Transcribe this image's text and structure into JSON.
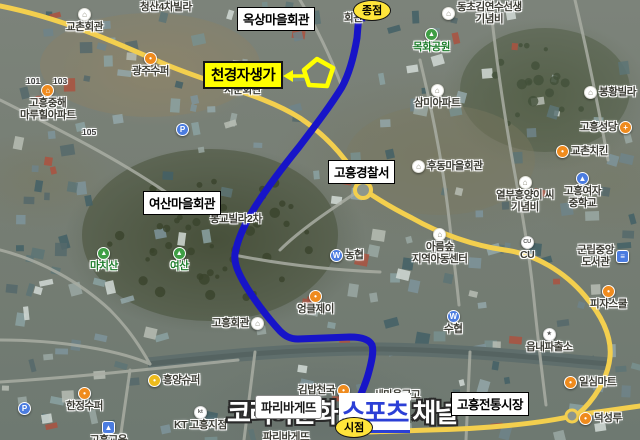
{
  "map_type": "satellite-route-map",
  "badges": {
    "end": "종점",
    "start": "시점"
  },
  "callout": {
    "label": "천경자생가"
  },
  "boxed_labels": {
    "oksang": "옥상마을회관",
    "police": "고흥경찰서",
    "yeosan": "여산마을회관",
    "market": "고흥전통시장",
    "paris": "파리바게뜨"
  },
  "watermark": {
    "part1": "코리아문화",
    "part2": "스포츠",
    "part3": "채널"
  },
  "icons": {
    "mountain": "▲",
    "hall": "⌂",
    "dot": "•",
    "bank": "W",
    "parking": "P",
    "church": "+",
    "school": "▲",
    "police": "★",
    "cu": "CU",
    "kt": "kt",
    "library": "≡",
    "home": "⌂"
  },
  "colors": {
    "route": "#1714c8",
    "road_main": "#f3cf4e",
    "highlight": "#ffff00",
    "badge": "#ffe53a",
    "watermark_accent": "#2b3fd6"
  },
  "pois": [
    {
      "label": "청산4차빌라"
    },
    {
      "label": "교촌회관"
    },
    {
      "label": "광주수퍼"
    },
    {
      "label": "고흥중해\n마루힐아파트"
    },
    {
      "label": "101"
    },
    {
      "label": "103"
    },
    {
      "label": "105"
    },
    {
      "label": "서문회관"
    },
    {
      "label": "동초김연수선생\n기념비"
    },
    {
      "label": "목화공원"
    },
    {
      "label": "삼미아파트"
    },
    {
      "label": "봉황빌라"
    },
    {
      "label": "고흥성당"
    },
    {
      "label": "교촌치킨"
    },
    {
      "label": "고흥여자\n중학교"
    },
    {
      "label": "열부흥양이 씨\n기념비"
    },
    {
      "label": "후동마을회관"
    },
    {
      "label": "봉교빌라2차"
    },
    {
      "label": "마치산"
    },
    {
      "label": "여산"
    },
    {
      "label": "고흥회관"
    },
    {
      "label": "엉클제이"
    },
    {
      "label": "농협"
    },
    {
      "label": "아름숲\n지역아동센터"
    },
    {
      "label": "CU"
    },
    {
      "label": "군립중앙\n도서관"
    },
    {
      "label": "피자스쿨"
    },
    {
      "label": "수협"
    },
    {
      "label": "읍내파출소"
    },
    {
      "label": "일심마트"
    },
    {
      "label": "덕성루"
    },
    {
      "label": "새마을금고"
    },
    {
      "label": "올리브영"
    },
    {
      "label": "김밥천국"
    },
    {
      "label": "KT 고흥지점"
    },
    {
      "label": "한정수퍼"
    },
    {
      "label": "흥양슈퍼"
    },
    {
      "label": "고흥교육"
    },
    {
      "label": "파리바게뜨"
    },
    {
      "label": "회관"
    }
  ]
}
